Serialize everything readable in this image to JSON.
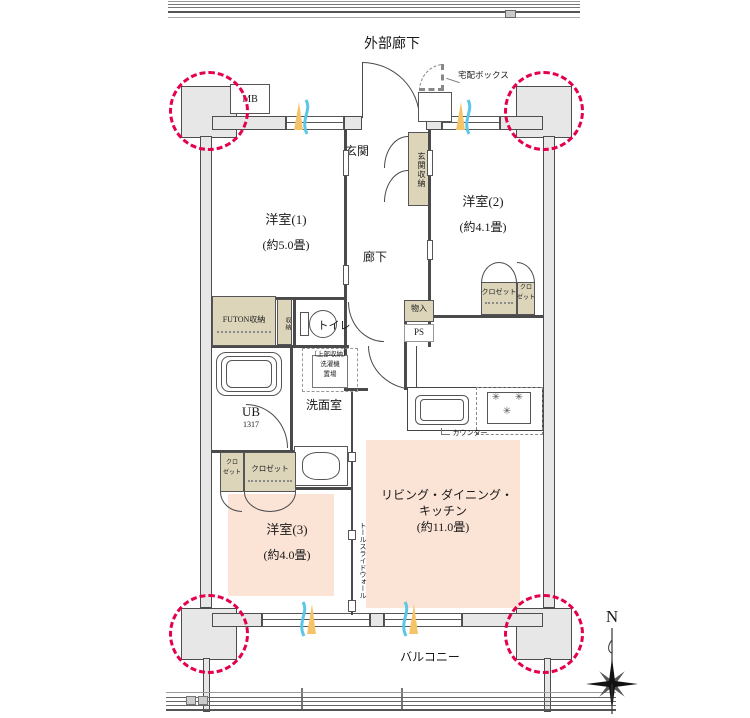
{
  "labels": {
    "exterior_corridor": "外部廊下",
    "balcony": "バルコニー",
    "north": "N",
    "meter_box": "MB",
    "delivery_box": "宅配ボックス",
    "entrance": "玄関",
    "entrance_storage": "玄関収納",
    "hallway": "廊下",
    "toilet": "トイレ",
    "futon_storage": "FUTON収納",
    "side_storage": "収納",
    "storage": "物入",
    "pipe_space": "PS",
    "unit_bath": "UB",
    "unit_bath_size": "1317",
    "washroom": "洗面室",
    "washer_upper": "〔上部収納〕",
    "washer_line1": "洗濯機",
    "washer_line2": "置場",
    "counter": "カウンター",
    "closet": "クロゼット",
    "closet_small_top": "クロ",
    "closet_small_bottom": "ゼット",
    "tall_slide_wall": "トールスライドウォール"
  },
  "rooms": {
    "western1": {
      "name": "洋室(1)",
      "size": "(約5.0畳)"
    },
    "western2": {
      "name": "洋室(2)",
      "size": "(約4.1畳)"
    },
    "western3": {
      "name": "洋室(3)",
      "size": "(約4.0畳)"
    },
    "ldk": {
      "line1": "リビング・ダイニング・",
      "line2": "キッチン",
      "size": "(約11.0畳)"
    }
  },
  "icons": {
    "burner": "✳"
  },
  "colors": {
    "room_highlight": "#fbe3d6",
    "storage_fill": "#dcd5ba",
    "wall_fill": "#e7e7e7",
    "pillar_circle": "#e4004b",
    "wind_blue": "#5cc6e8",
    "wind_orange": "#f5c469"
  }
}
